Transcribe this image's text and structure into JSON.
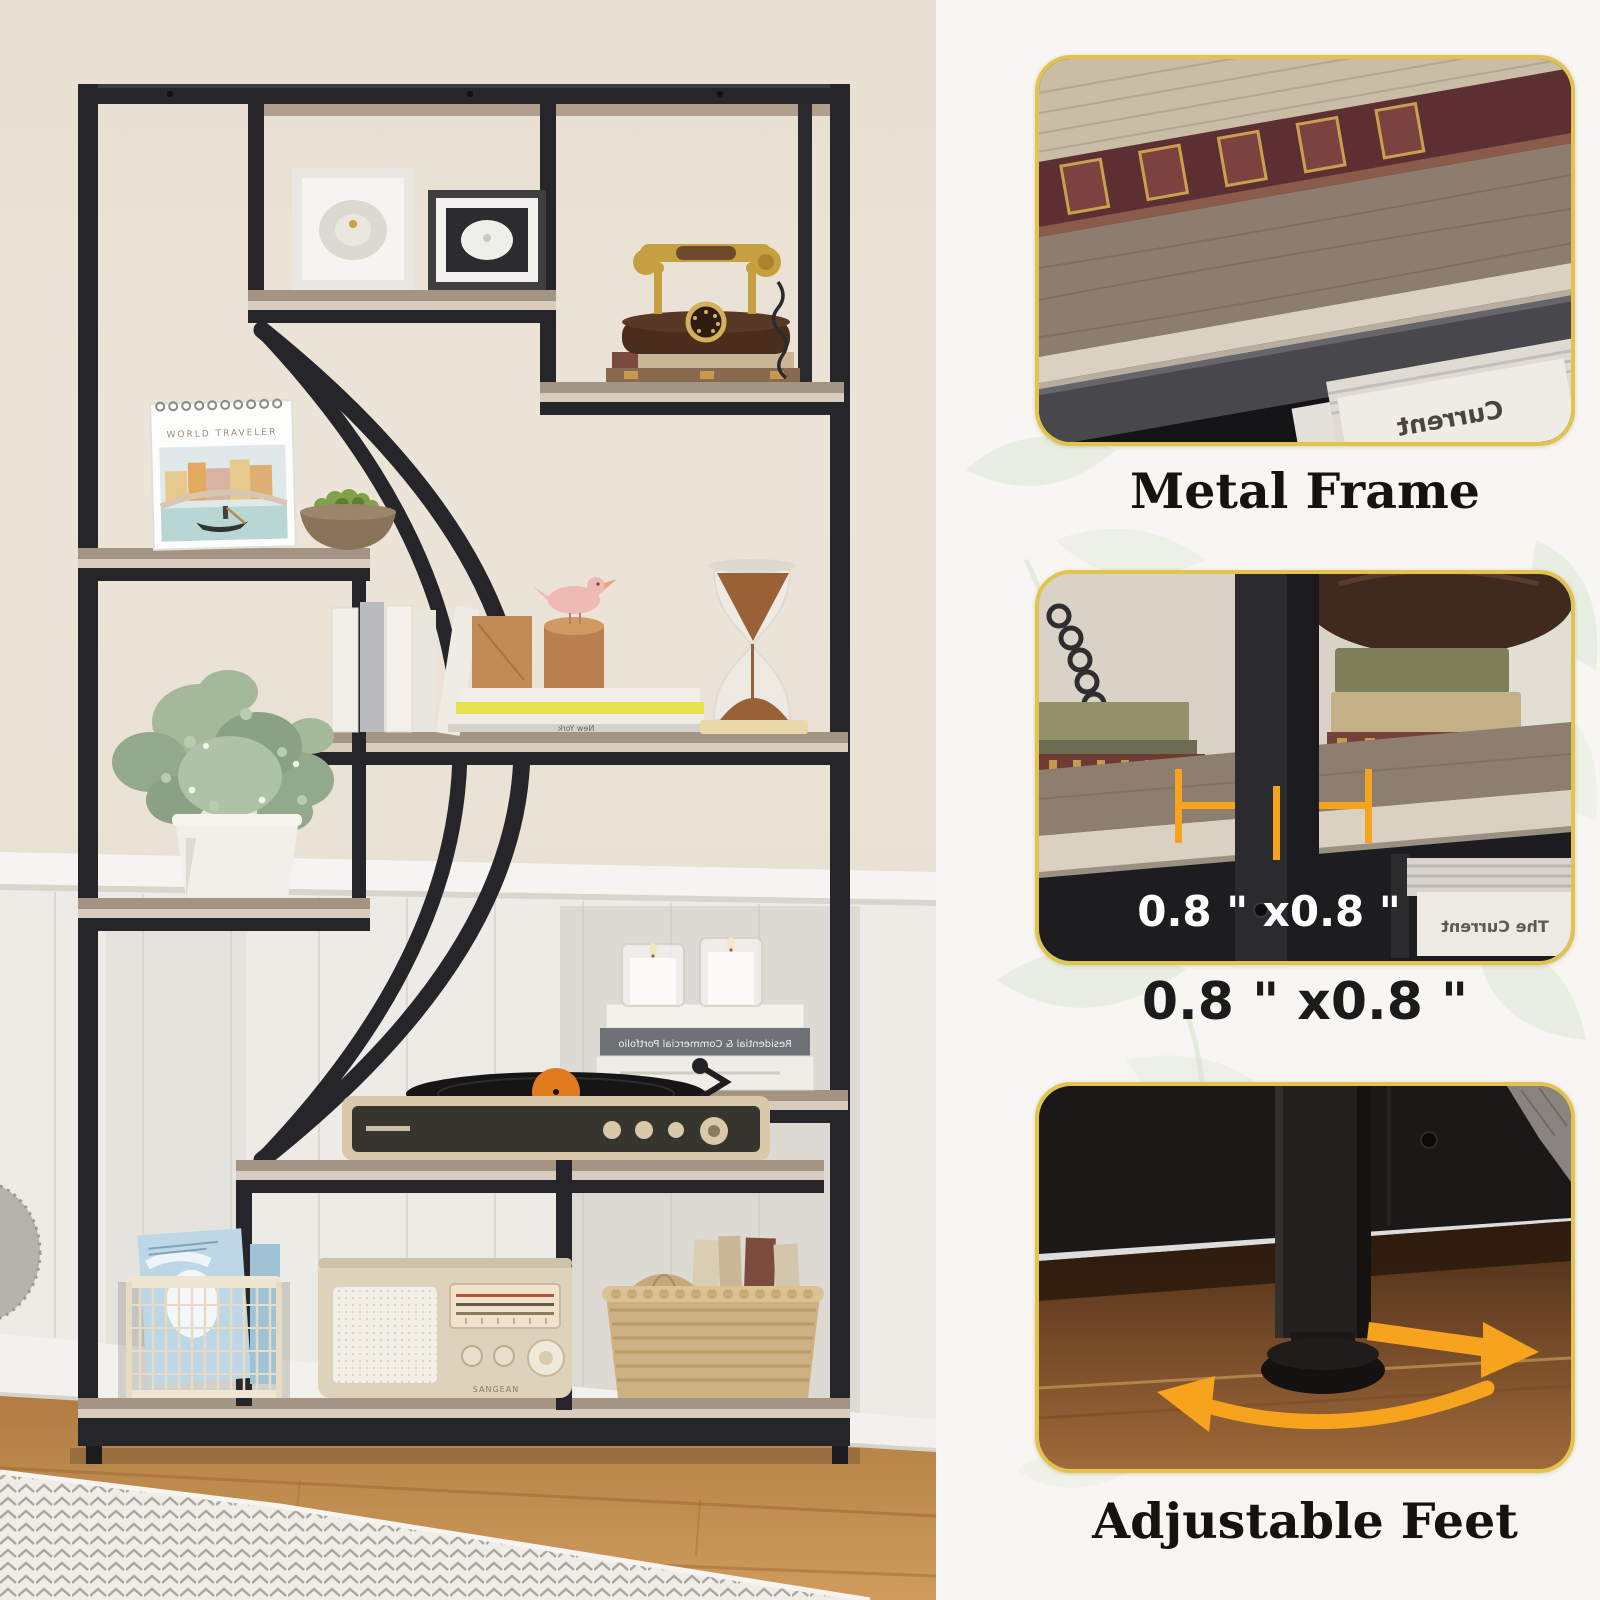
{
  "photo": {
    "calendar_title": "WORLD TRAVELER",
    "radio_brand": "SANGEAN",
    "book_spine_mirrored": "Residential & Commercial Portfolio",
    "book_stack_mirrored": "New York"
  },
  "panel": {
    "callouts": [
      {
        "label": "Metal Frame",
        "magazine_mirrored": "Current"
      },
      {
        "label": "0.8 \" x0.8 \"",
        "overlay": "0.8 \" x0.8 \"",
        "magazine_mirrored": "The Current"
      },
      {
        "label": "Adjustable Feet"
      }
    ]
  },
  "palette": {
    "accent_orange": "#f6a41d",
    "card_border_gold": "#e2c350",
    "panel_background": "#f8f6f2",
    "metal_black": "#26262a",
    "shelf_wood": "#a39484",
    "wall_cream": "#eae2d5",
    "floor_wood": "#c6914f"
  }
}
